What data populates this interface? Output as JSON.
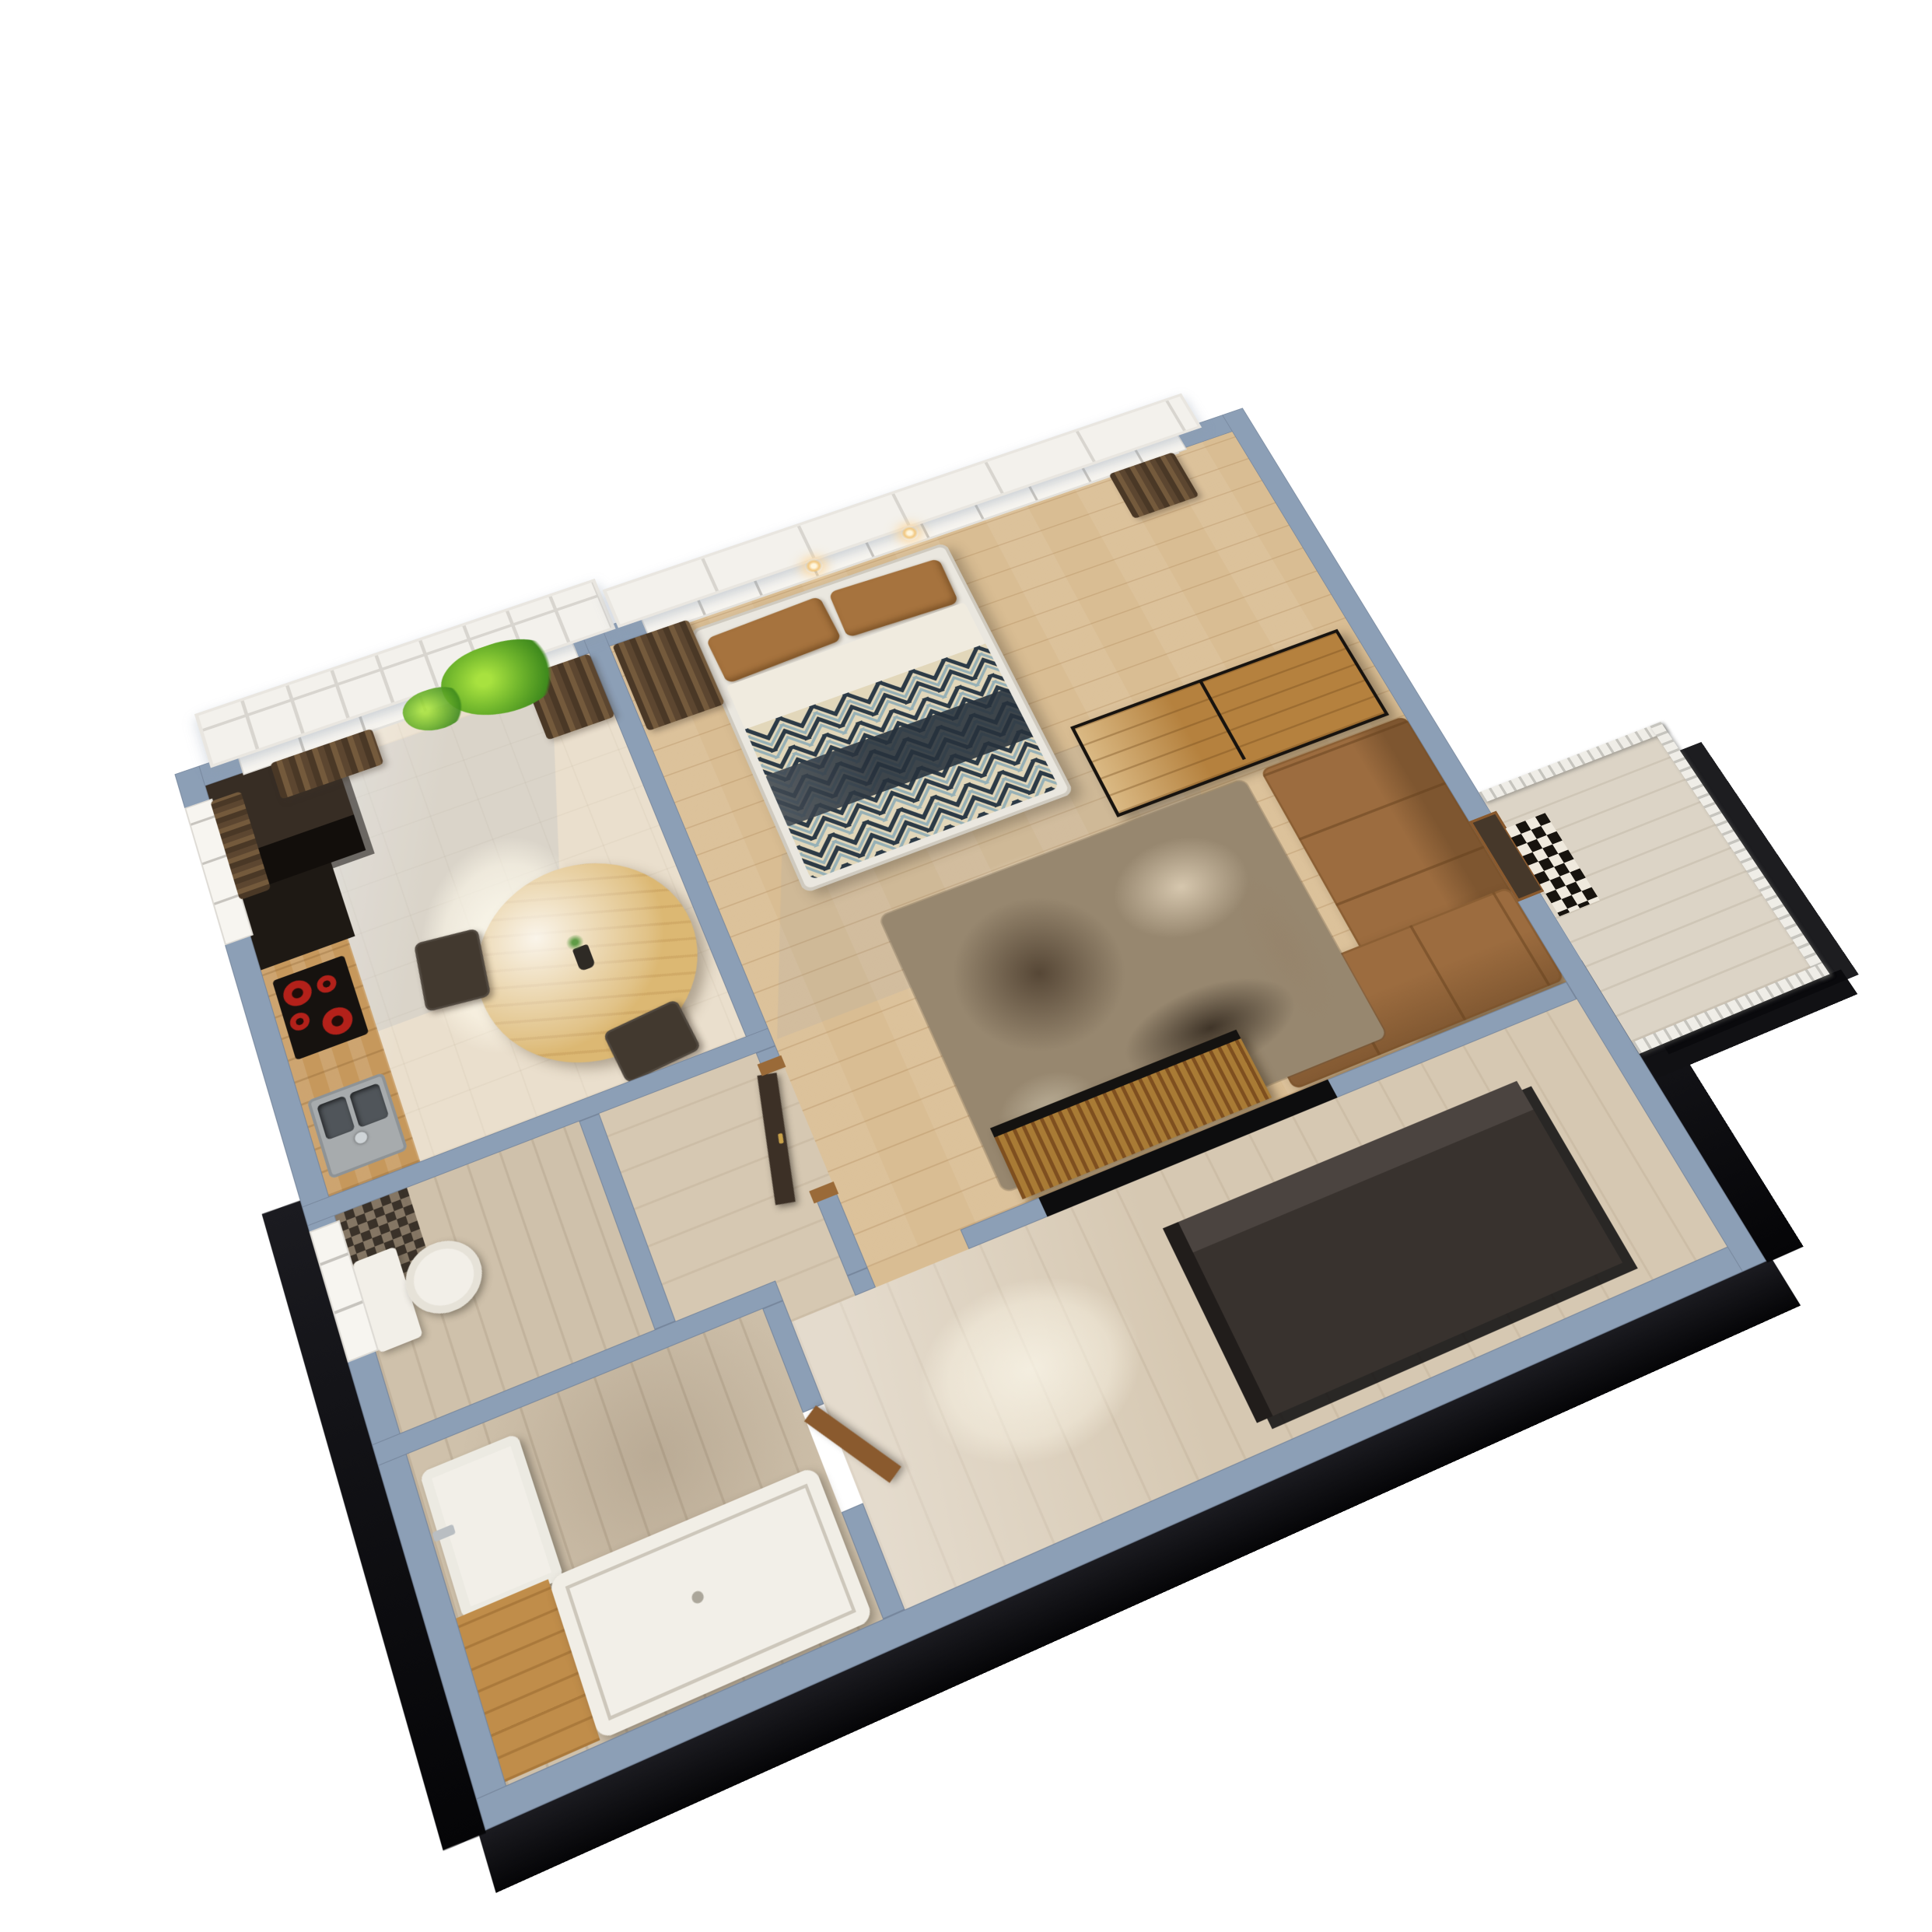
{
  "scene": {
    "title": "apartment-3d-floor-plan-render",
    "view": {
      "projection": "isometric-perspective",
      "rotation_deg": -23,
      "tilt_deg": 30
    },
    "background": "#ffffff",
    "rooms": [
      {
        "name": "kitchen-dining",
        "floor": "glossy-beige-tile",
        "features": [
          "north-window",
          "west-window",
          "french-balcony-frame"
        ]
      },
      {
        "name": "bedroom-living",
        "floor": "light-oak-plank",
        "features": [
          "panorama-window",
          "wall-sconces"
        ]
      },
      {
        "name": "hallway-entry",
        "floor": "travertine"
      },
      {
        "name": "wc",
        "floor": "travertine",
        "features": [
          "mosaic-accent-tile"
        ]
      },
      {
        "name": "bathroom",
        "floor": "travertine",
        "features": [
          "wood-tub-deck"
        ]
      },
      {
        "name": "balcony",
        "floor": "stone",
        "features": [
          "white-slat-railing",
          "checkered-rack"
        ]
      }
    ],
    "furniture": [
      {
        "name": "tall-kitchen-cabinet",
        "room": "kitchen-dining"
      },
      {
        "name": "dark-base-cabinet",
        "room": "kitchen-dining"
      },
      {
        "name": "wood-countertop",
        "room": "kitchen-dining"
      },
      {
        "name": "induction-cooktop",
        "room": "kitchen-dining",
        "burners": 4
      },
      {
        "name": "double-bowl-sink",
        "room": "kitchen-dining"
      },
      {
        "name": "round-dining-table",
        "room": "kitchen-dining",
        "seats": 2
      },
      {
        "name": "flower-vase",
        "room": "kitchen-dining"
      },
      {
        "name": "hanging-plant",
        "room": "kitchen-dining"
      },
      {
        "name": "brown-curtain",
        "count": 5
      },
      {
        "name": "double-bed",
        "room": "bedroom-living",
        "pillows": 2
      },
      {
        "name": "chevron-duvet",
        "room": "bedroom-living"
      },
      {
        "name": "navy-throw",
        "room": "bedroom-living"
      },
      {
        "name": "wall-sconce",
        "count": 2
      },
      {
        "name": "open-shelf-divider",
        "room": "bedroom-living"
      },
      {
        "name": "corner-sofa",
        "room": "bedroom-living"
      },
      {
        "name": "floor-lamp",
        "room": "bedroom-living"
      },
      {
        "name": "area-rug",
        "room": "bedroom-living"
      },
      {
        "name": "slatted-tv-console",
        "room": "bedroom-living"
      },
      {
        "name": "tv-wall-niche",
        "room": "bedroom-living"
      },
      {
        "name": "hall-wardrobe",
        "room": "hallway-entry"
      },
      {
        "name": "entrance-door",
        "room": "hallway-entry"
      },
      {
        "name": "bathroom-door",
        "room": "bathroom"
      },
      {
        "name": "balcony-door",
        "room": "balcony"
      },
      {
        "name": "wall-hung-toilet",
        "room": "wc"
      },
      {
        "name": "washbasin",
        "room": "bathroom"
      },
      {
        "name": "bathtub",
        "room": "bathroom"
      }
    ],
    "palette": {
      "wall": "#8c9fb6",
      "windowWhite": "#f7f5f0",
      "frameWhite": "#f3f1ec",
      "kitchenFloor": "#eadfcd",
      "woodFloor": "#d9bd93",
      "hallFloor": "#d6c8b2",
      "bathFloor": "#cfc1ab",
      "balconyFloor": "#dcd4c6",
      "cabinetDark": "#372d24",
      "cabinetBlack": "#1e1914",
      "counterWood": "#c6985c",
      "cooktopBlack": "#16120f",
      "burnerRed": "#b3211a",
      "steel": "#a7abad",
      "tableWood": "#dcb873",
      "chair": "#42392f",
      "vase": "#2e2a25",
      "curtain": "#6a5138",
      "plantGreen": "#6fb52c",
      "bedFrame": "#eae7df",
      "pillow": "#a6733e",
      "sheetWhite": "#f0ebdf",
      "duvetBase": "#e2d7ba",
      "chevronNavy": "#2c3a46",
      "chevronBlue": "#7da3b5",
      "throwNavy": "#27313c",
      "shelfWood": "#b5813e",
      "metalFrame": "#17130f",
      "sofa": "#9c6c3f",
      "rugBase": "#97876f",
      "tvWood": "#a97b35",
      "nicheBlack": "#0d0d0e",
      "wardrobe": "#38322e",
      "doorLeaf": "#3c3026",
      "doorWood": "#8a5a2e",
      "balconyDoor": "#46382a",
      "fixtureWhite": "#f2efe8",
      "deckWood": "#c08d4a",
      "railWhite": "#efede7",
      "checkLight": "#efe9dd",
      "mosaicBase": "#7c6e5d",
      "glow": "#ffdca6",
      "extrude": "#101014"
    }
  }
}
